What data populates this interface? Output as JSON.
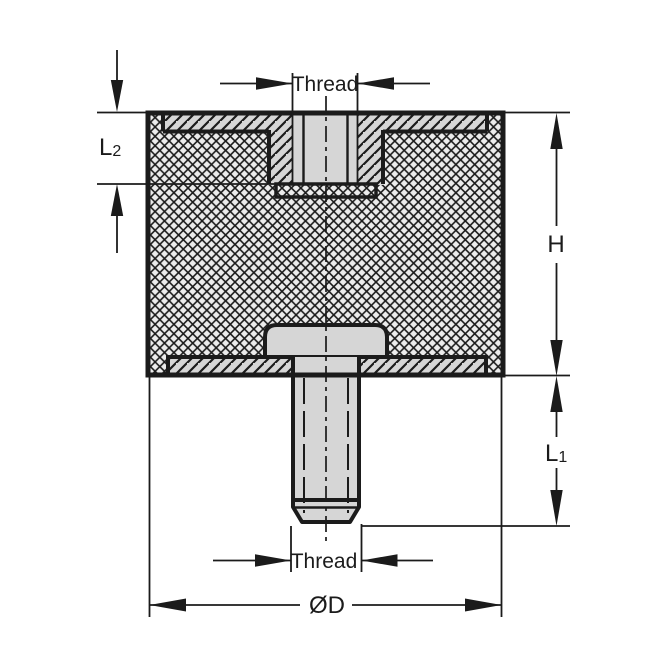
{
  "drawing": {
    "labels": {
      "thread_top": "Thread",
      "thread_bottom": "Thread",
      "height_dim": "H",
      "l1_main": "L",
      "l1_sub": "1",
      "l2_main": "L",
      "l2_sub": "2",
      "diameter_dim": "ØD"
    },
    "colors": {
      "line": "#1b1b1b",
      "metal_fill": "#d6d6d6",
      "rubber_fill": "#ececec",
      "background": "#ffffff"
    }
  }
}
